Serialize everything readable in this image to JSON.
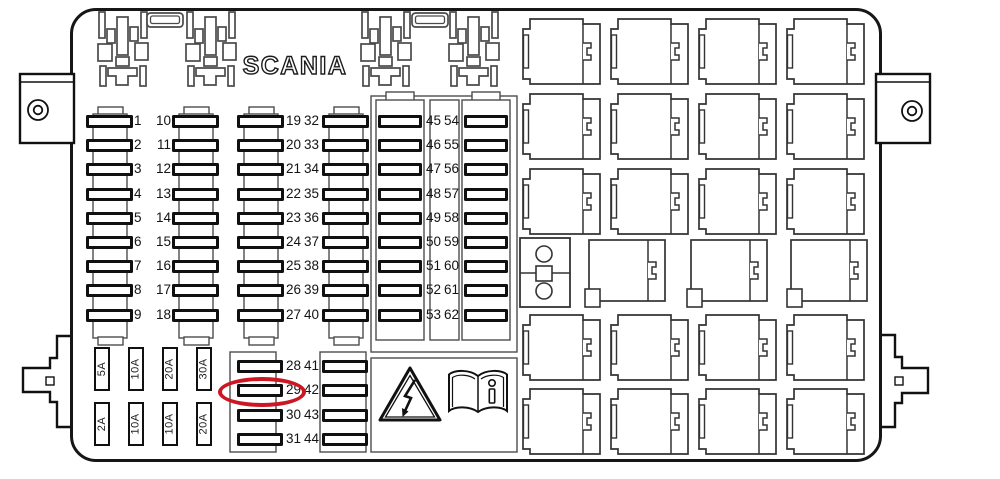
{
  "brand": {
    "logo": "SCANIA"
  },
  "colors": {
    "line": "#161616",
    "highlight_ring": "#cc1622"
  },
  "fuse_panel": {
    "group_1_18": {
      "left": [
        "1",
        "2",
        "3",
        "4",
        "5",
        "6",
        "7",
        "8",
        "9"
      ],
      "right": [
        "10",
        "11",
        "12",
        "13",
        "14",
        "15",
        "16",
        "17",
        "18"
      ]
    },
    "group_19_40": {
      "left": [
        "19",
        "20",
        "21",
        "22",
        "23",
        "24",
        "25",
        "26",
        "27"
      ],
      "right": [
        "32",
        "33",
        "34",
        "35",
        "36",
        "37",
        "38",
        "39",
        "40"
      ]
    },
    "group_45_62": {
      "left": [
        "45",
        "46",
        "47",
        "48",
        "49",
        "50",
        "51",
        "52",
        "53"
      ],
      "right": [
        "54",
        "55",
        "56",
        "57",
        "58",
        "59",
        "60",
        "61",
        "62"
      ]
    },
    "group_28_44": {
      "left": [
        "28",
        "29",
        "30",
        "31"
      ],
      "right": [
        "41",
        "42",
        "43",
        "44"
      ]
    },
    "spare_fuses": {
      "top_row": [
        "5A",
        "10A",
        "20A",
        "30A"
      ],
      "bottom_row": [
        "2A",
        "10A",
        "10A",
        "20A"
      ]
    },
    "highlighted_fuse": "29"
  },
  "icons": {
    "warning": "high-voltage-warning-icon",
    "manual": "owners-manual-icon"
  }
}
